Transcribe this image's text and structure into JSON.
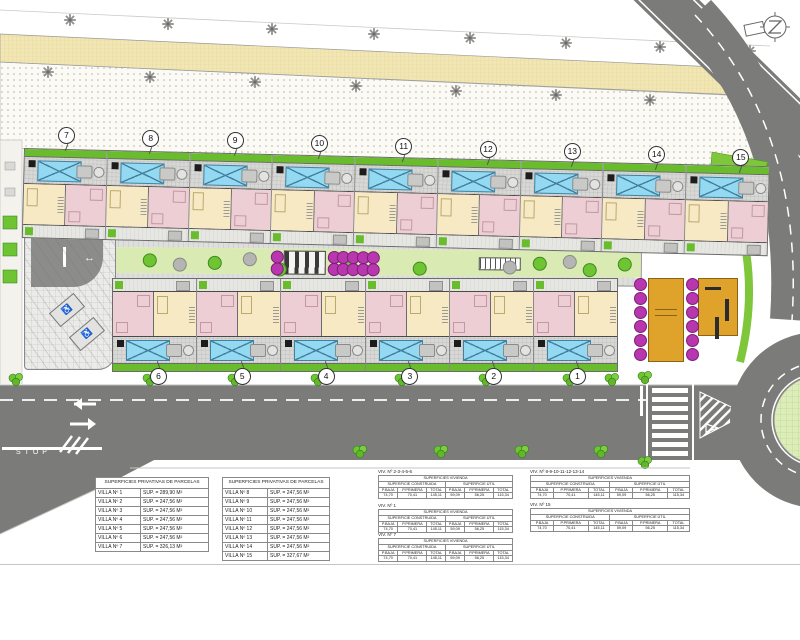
{
  "markers": {
    "top": [
      "7",
      "8",
      "9",
      "10",
      "11",
      "12",
      "13",
      "14",
      "15"
    ],
    "bottom": [
      "6",
      "5",
      "4",
      "3",
      "2",
      "1"
    ]
  },
  "road": {
    "stop": "STOP"
  },
  "parcel_tables": [
    {
      "title": "SUPERFICIES PRIVATIVAS DE PARCELAS",
      "rows": [
        {
          "name": "VILLA Nº 1",
          "sup": "SUP. = 289,90 M²"
        },
        {
          "name": "VILLA Nº 2",
          "sup": "SUP. = 247,56 M²"
        },
        {
          "name": "VILLA Nº 3",
          "sup": "SUP. = 247,56 M²"
        },
        {
          "name": "VILLA Nº 4",
          "sup": "SUP. = 247,56 M²"
        },
        {
          "name": "VILLA Nº 5",
          "sup": "SUP. = 247,56 M²"
        },
        {
          "name": "VILLA Nº 6",
          "sup": "SUP. = 247,56 M²"
        },
        {
          "name": "VILLA Nº 7",
          "sup": "SUP. = 326,13 M²"
        }
      ]
    },
    {
      "title": "SUPERFICIES PRIVATIVAS DE PARCELAS",
      "rows": [
        {
          "name": "VILLA Nº 8",
          "sup": "SUP. = 247,56 M²"
        },
        {
          "name": "VILLA Nº 9",
          "sup": "SUP. = 247,56 M²"
        },
        {
          "name": "VILLA Nº 10",
          "sup": "SUP. = 247,56 M²"
        },
        {
          "name": "VILLA Nº 11",
          "sup": "SUP. = 247,56 M²"
        },
        {
          "name": "VILLA Nº 12",
          "sup": "SUP. = 247,56 M²"
        },
        {
          "name": "VILLA Nº 13",
          "sup": "SUP. = 247,56 M²"
        },
        {
          "name": "VILLA Nº 14",
          "sup": "SUP. = 247,56 M²"
        },
        {
          "name": "VILLA Nº 15",
          "sup": "SUP. = 327,67 M²"
        }
      ]
    }
  ],
  "unit_tables": [
    {
      "label": "VIV. Nº 2-3-4-5-6",
      "title": "SUPERFICIES VIVIENDA",
      "groups": [
        "SUPERFICIE CONSTRUIDA",
        "SUPERFICIE ÚTIL"
      ],
      "cols": [
        "P.BAJA",
        "P.PRIMERA",
        "TOTAL",
        "P.BAJA",
        "P.PRIMERA",
        "TOTAL"
      ],
      "values": [
        "74,70",
        "70,41",
        "145,11",
        "59,09",
        "56,25",
        "115,34"
      ]
    },
    {
      "label": "VIV. Nº 1",
      "title": "SUPERFICIES VIVIENDA",
      "groups": [
        "SUPERFICIE CONSTRUIDA",
        "SUPERFICIE ÚTIL"
      ],
      "cols": [
        "P.BAJA",
        "P.PRIMERA",
        "TOTAL",
        "P.BAJA",
        "P.PRIMERA",
        "TOTAL"
      ],
      "values": [
        "74,70",
        "70,41",
        "145,11",
        "59,09",
        "56,25",
        "115,34"
      ]
    },
    {
      "label": "VIV. Nº 7",
      "title": "SUPERFICIES VIVIENDA",
      "groups": [
        "SUPERFICIE CONSTRUIDA",
        "SUPERFICIE ÚTIL"
      ],
      "cols": [
        "P.BAJA",
        "P.PRIMERA",
        "TOTAL",
        "P.BAJA",
        "P.PRIMERA",
        "TOTAL"
      ],
      "values": [
        "74,70",
        "70,41",
        "145,11",
        "59,09",
        "56,25",
        "115,34"
      ]
    },
    {
      "label": "VIV. Nº 8-9-10-11-12-13-14",
      "title": "SUPERFICIES VIVIENDA",
      "groups": [
        "SUPERFICIE CONSTRUIDA",
        "SUPERFICIE ÚTIL"
      ],
      "cols": [
        "P.BAJA",
        "P.PRIMERA",
        "TOTAL",
        "P.BAJA",
        "P.PRIMERA",
        "TOTAL"
      ],
      "values": [
        "74,70",
        "70,41",
        "145,11",
        "59,09",
        "56,25",
        "115,34"
      ]
    },
    {
      "label": "VIV. Nº 15",
      "title": "SUPERFICIES VIVIENDA",
      "groups": [
        "SUPERFICIE CONSTRUIDA",
        "SUPERFICIE ÚTIL"
      ],
      "cols": [
        "P.BAJA",
        "P.PRIMERA",
        "TOTAL",
        "P.BAJA",
        "P.PRIMERA",
        "TOTAL"
      ],
      "values": [
        "74,70",
        "70,41",
        "145,11",
        "59,09",
        "56,25",
        "115,34"
      ]
    }
  ],
  "colors": {
    "grass": "#69bd2d",
    "pool": "#93d9f1",
    "room_cream": "#f6e9c4",
    "room_pink": "#edced4",
    "road": "#7b7b79",
    "sand_band": "#f1e6b4",
    "magenta": "#b836ae",
    "amber": "#dfa22b",
    "spine_green": "#d9eab2",
    "roundabout_green": "#dcedba"
  }
}
